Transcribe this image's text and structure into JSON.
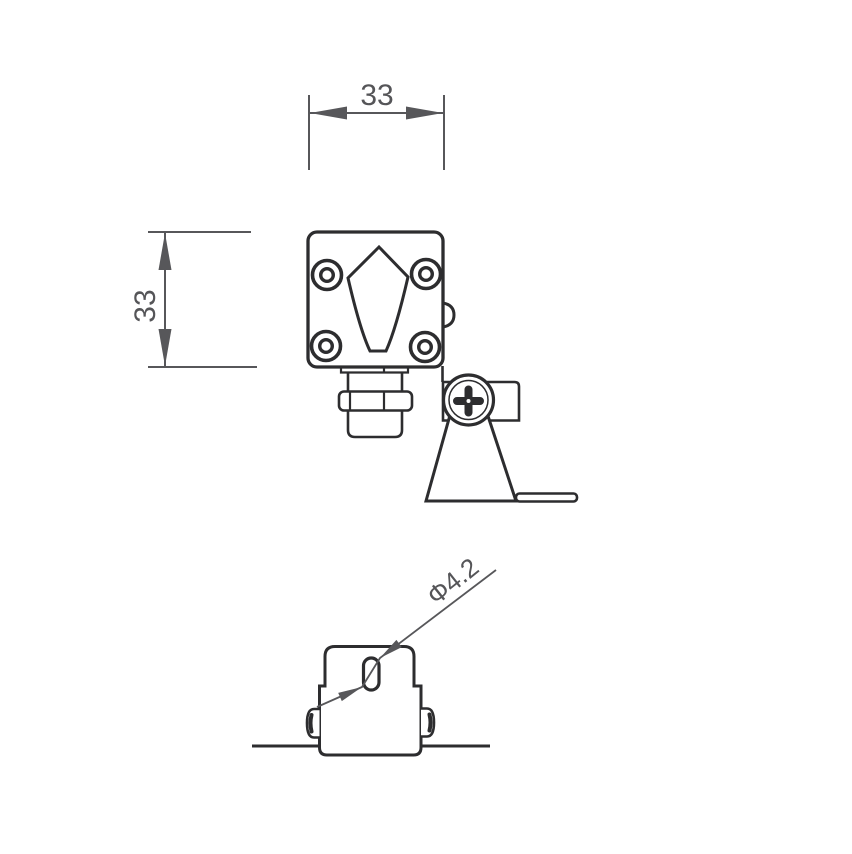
{
  "drawing": {
    "type": "technical-dimension-drawing",
    "subject": "wall-mounted mini spotlight / sensor fixture, two orthographic views",
    "colors": {
      "background": "#ffffff",
      "outline": "#2d2d2f",
      "dimension": "#57575a"
    },
    "front_view": {
      "width_dimension": {
        "label": "33",
        "orientation": "horizontal"
      },
      "height_dimension": {
        "label": "33",
        "orientation": "vertical"
      },
      "features": [
        "square housing with four corner screws",
        "kite-shaped emblem",
        "side bump",
        "cable gland below",
        "mounting bracket with phillips screw and foot"
      ]
    },
    "bottom_view": {
      "hole_dimension": {
        "label": "Φ4.2",
        "orientation": "diagonal-leader"
      },
      "features": [
        "slotted mounting hole",
        "two side screws",
        "mounting surface line"
      ]
    }
  }
}
